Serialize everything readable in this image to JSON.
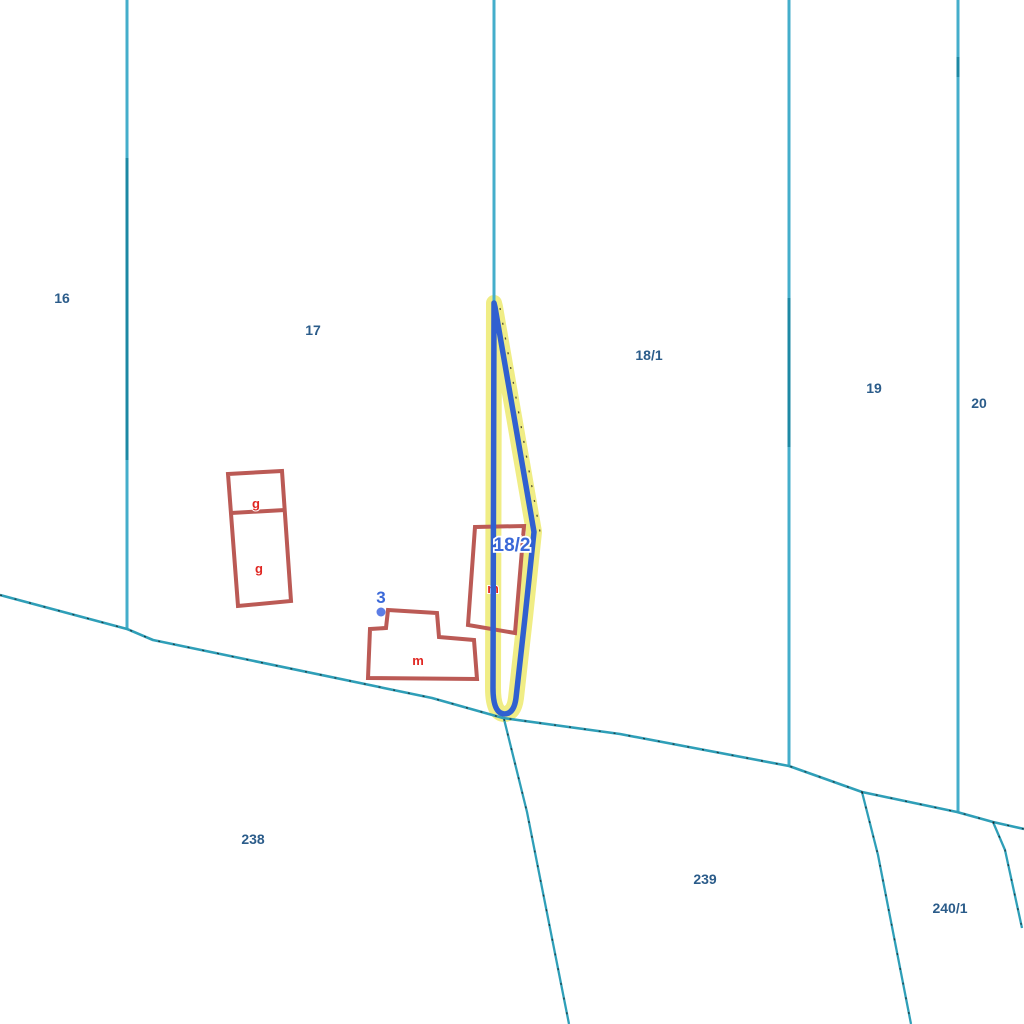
{
  "map": {
    "background": "#ffffff",
    "selected_parcel": {
      "label": "18/2"
    },
    "address_point": {
      "label": "3"
    },
    "parcel_labels": [
      {
        "text": "16"
      },
      {
        "text": "17"
      },
      {
        "text": "18/1"
      },
      {
        "text": "19"
      },
      {
        "text": "20"
      },
      {
        "text": "238"
      },
      {
        "text": "239"
      },
      {
        "text": "240/1"
      }
    ],
    "building_labels": [
      {
        "text": "g"
      },
      {
        "text": "g"
      },
      {
        "text": "m"
      },
      {
        "text": "m"
      }
    ],
    "colors": {
      "parcel_boundary": "#44aecb",
      "parcel_boundary_overlap": "#1d89a4",
      "road_boundary": "#2f9fb8",
      "parcel_number_text": "#2b5c8a",
      "building_outline": "#bb5a55",
      "building_text": "#e02722",
      "selection_outline": "#3060d0",
      "selection_halo": "#f0ed85",
      "address_text": "#3a68d8",
      "address_point_fill": "#5c7de5",
      "tick_marks": "#1a1a1a"
    }
  }
}
